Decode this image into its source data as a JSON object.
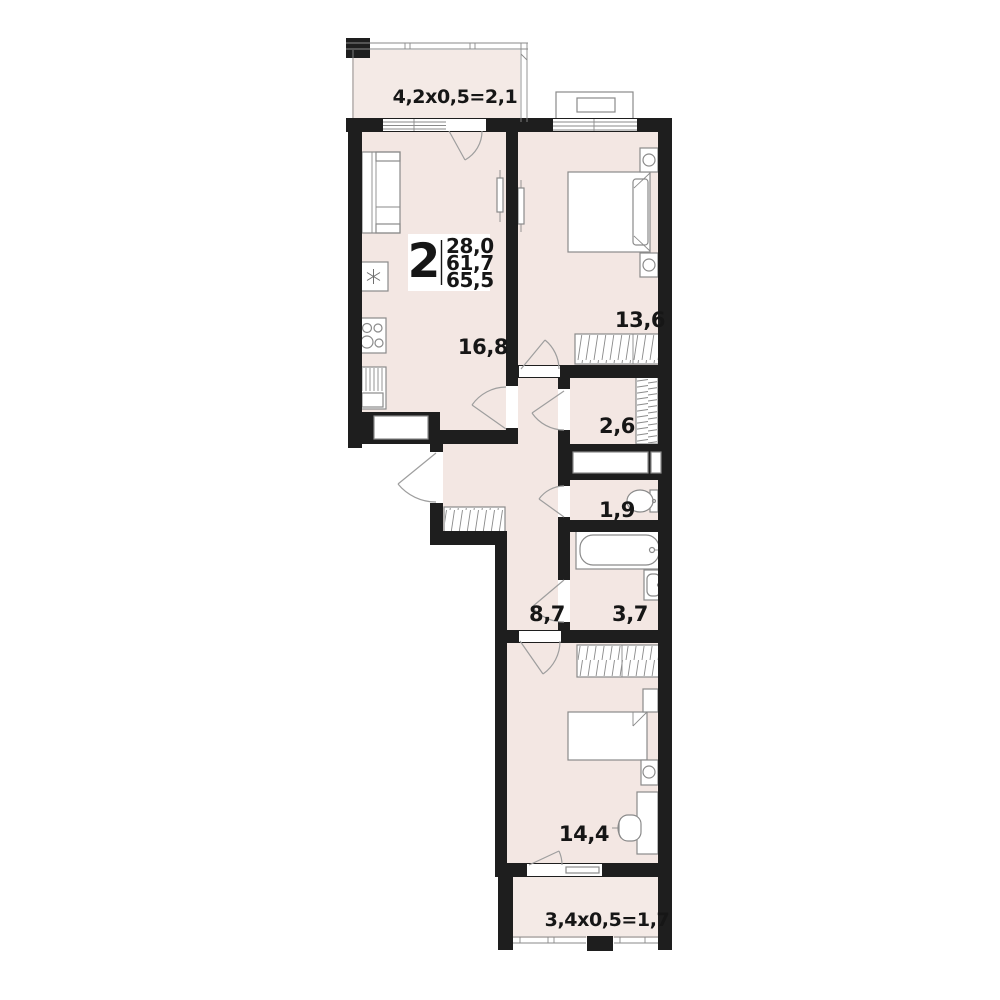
{
  "plan_title": "2-room apartment floor plan",
  "info_box": {
    "room_count": "2",
    "area_living": "28,0",
    "area_main": "61,7",
    "area_total": "65,5"
  },
  "labels": {
    "balcony_top": "4,2x0,5=2,1",
    "living_kitchen": "16,8",
    "bedroom_1": "13,6",
    "closet": "2,6",
    "wc": "1,9",
    "hall": "8,7",
    "bathroom": "3,7",
    "bedroom_2": "14,4",
    "balcony_bottom": "3,4x0,5=1,7"
  },
  "colors": {
    "wall": "#1e1e1e",
    "room_floor": "#f3e7e3",
    "balcony_floor": "#f4eae6",
    "furniture_stroke": "#8a8a8a",
    "text": "#161616",
    "background": "#ffffff"
  }
}
